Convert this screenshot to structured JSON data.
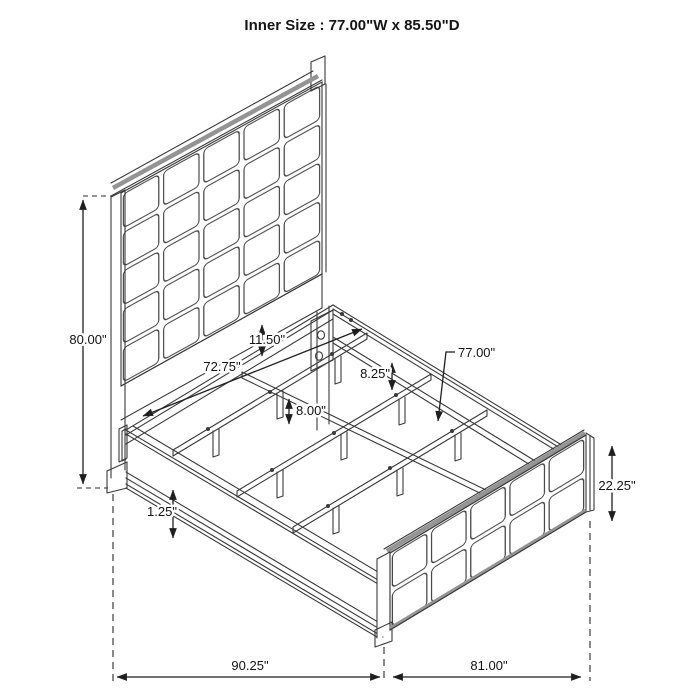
{
  "title": "Inner Size : 77.00\"W x 85.50\"D",
  "diagram": {
    "subject": "upholstered panel bed isometric dimension drawing",
    "colors": {
      "background": "#ffffff",
      "drawing_line": "#3a3a3a",
      "dimension_line": "#1f1f1f",
      "shading": "#949494",
      "text": "#111111"
    }
  },
  "dimensions": {
    "headboard_height": "80.00\"",
    "panel_to_rail_gap": "11.50\"",
    "headboard_inner_width": "72.75\"",
    "side_rail_height": "8.25\"",
    "slat_length": "77.00\"",
    "slat_leg_height": "8.00\"",
    "footboard_height": "22.25\"",
    "rail_base_trim": "1.25\"",
    "overall_length": "90.25\"",
    "footboard_width": "81.00\""
  }
}
